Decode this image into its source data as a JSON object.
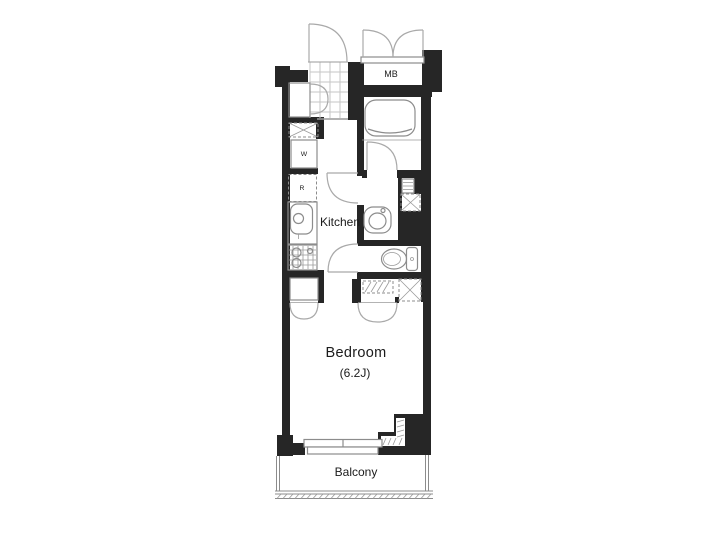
{
  "floor_plan": {
    "labels": {
      "meter_box": "MB",
      "kitchen": "Kitchen",
      "bedroom": "Bedroom",
      "bedroom_size": "(6.2J)",
      "balcony": "Balcony",
      "washer_space": "W",
      "refrigerator_space": "R"
    },
    "colors": {
      "wall": "#262626",
      "fixture_line": "#8c8c8c",
      "door_arc": "#a9a9a9",
      "tile_line": "#c6c6c6",
      "text": "#1b1b1b",
      "background": "#ffffff"
    }
  }
}
